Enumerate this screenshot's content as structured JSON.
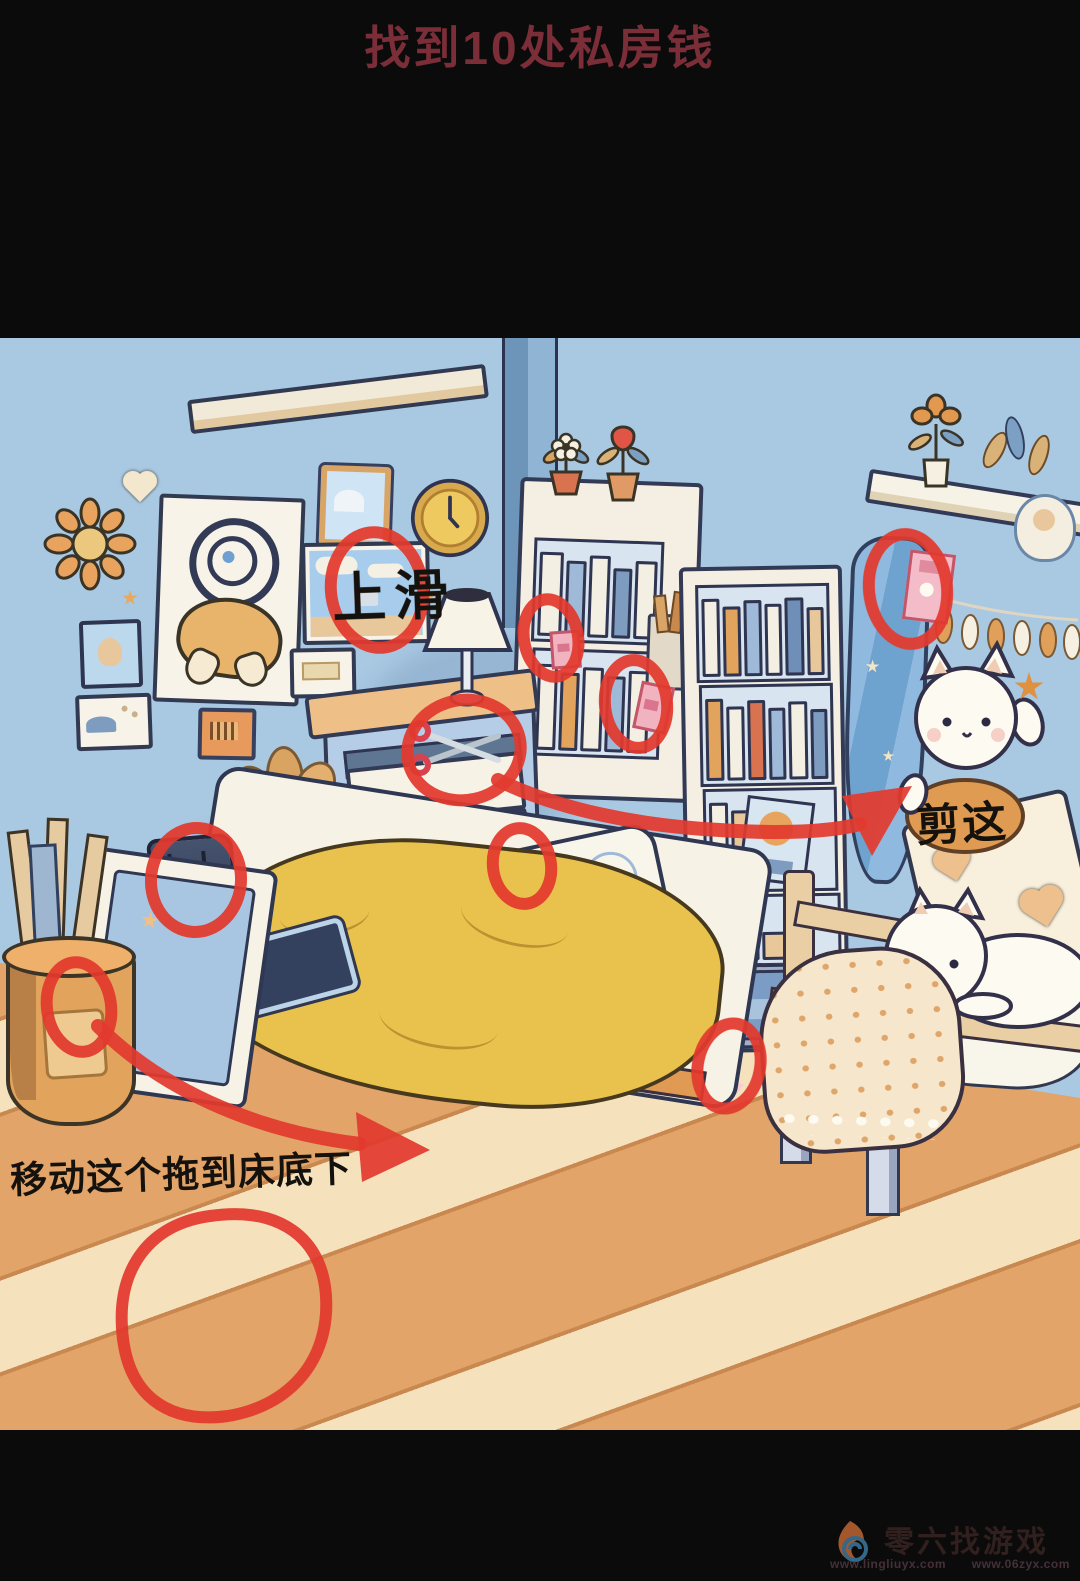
{
  "title": {
    "text": "找到10处私房钱",
    "color": "#7b2e38"
  },
  "scene": {
    "hidden_spot_count": 10,
    "annotation_color": "#e23a2e",
    "labels": {
      "swipe_up": "上滑",
      "cut_this": "剪这",
      "move_hint": "移动这个拖到床底下"
    },
    "hidden_spots": [
      "landscape-picture",
      "bookshelf-books-banknote",
      "bookshelf-side-envelope",
      "nightstand-open-drawer",
      "pillow",
      "bed-speaker",
      "umbrella-basket",
      "hanging-towel-envelope",
      "under-tall-bookshelf",
      "floorboard"
    ]
  },
  "watermark": {
    "name": "零六找游戏",
    "url_left": "www.lingliuyx.com",
    "url_right": "www.06zyx.com"
  },
  "colors": {
    "bar": "#0b0b0c",
    "wall": "#a9c8e2",
    "wall_corner": "#6d95ba",
    "floor": "#e2a468",
    "floor_stripe": "#f5e2bd",
    "blanket": "#e9c24d",
    "annotation_red": "#e23a2e",
    "title_red": "#7b2e38"
  }
}
